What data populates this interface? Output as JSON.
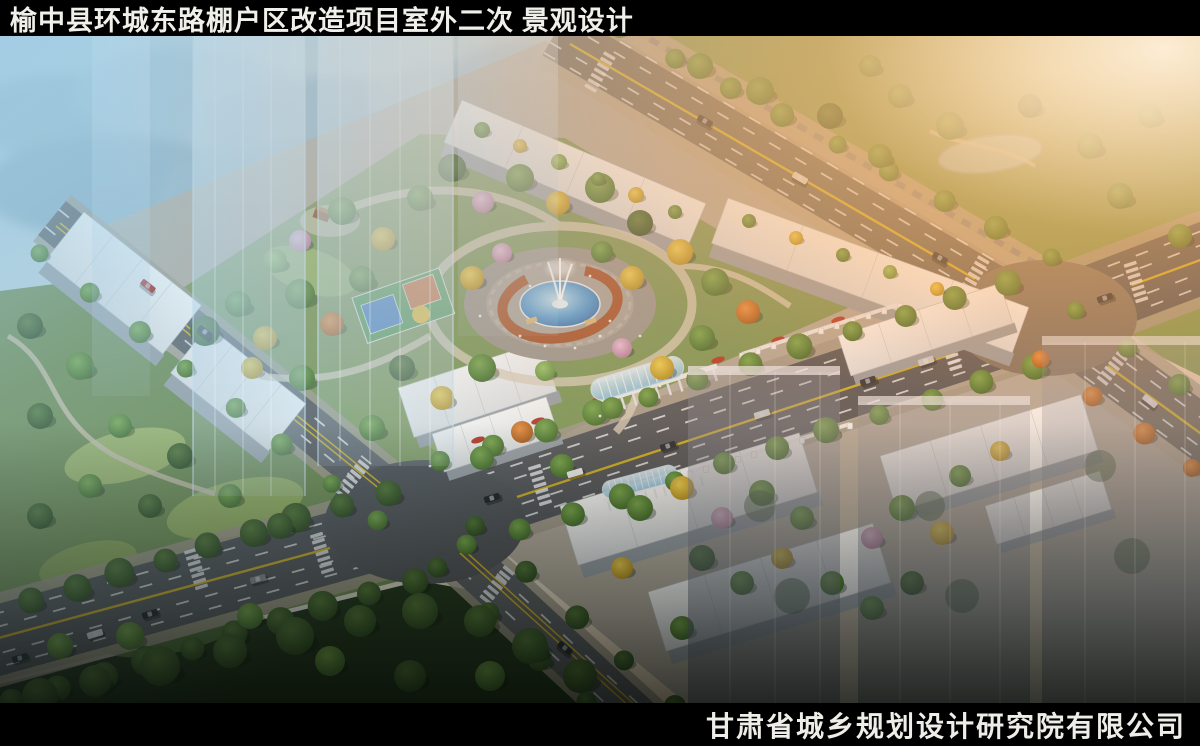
{
  "header": {
    "title": "榆中县环城东路棚户区改造项目室外二次 景观设计"
  },
  "footer": {
    "company": "甘肃省城乡规划设计研究院有限公司"
  },
  "colors": {
    "bar_background": "#000000",
    "title_text": "#f0efe9",
    "mist_blue": "#a9cade",
    "sunset_glow": "#ffae64",
    "foliage_green": "#5d8a3e",
    "autumn_yellow": "#d9b832",
    "blossom_pink": "#d9a8c8",
    "pergola_rust": "#a8562c",
    "pool_blue": "#3f86c4",
    "road_gray": "#55595d",
    "building_white": "#f2f3f2"
  }
}
